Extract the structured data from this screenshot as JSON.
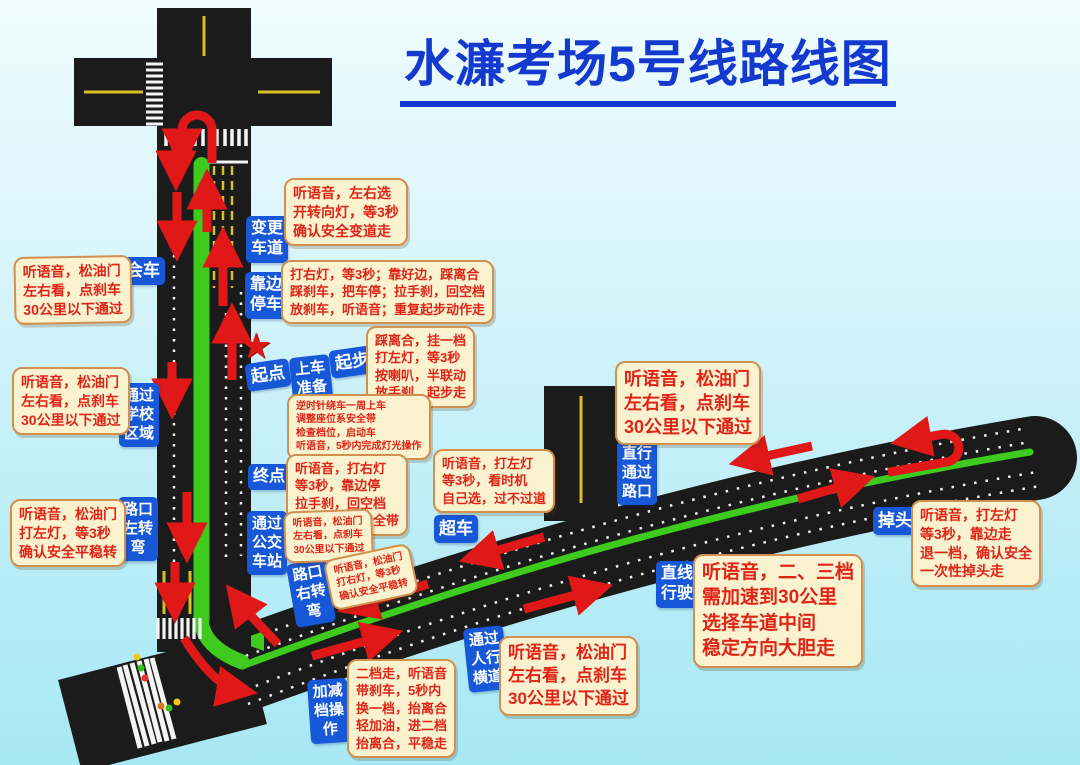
{
  "title": "水濂考场5号线路线图",
  "icons": {
    "star": "★"
  },
  "colors": {
    "title_blue": "#1439cf",
    "label_bg": "#1658d8",
    "note_bg": "#fbf3cf",
    "note_border": "#cf9050",
    "note_text": "#e02518",
    "road": "#1b1b1b",
    "median_green": "#3ecb1e",
    "arrow_red": "#e11818",
    "lane_yellow": "#d8c022"
  },
  "labels": {
    "huiche": "会车",
    "biangeng": "变更\n车道",
    "kaobian": "靠边\n停车",
    "qidian": "起点",
    "shangche": "上车\n准备",
    "qibu": "起步",
    "xuexiao": "通过\n学校\n区域",
    "zhongdian": "终点",
    "gongjiao": "通过\n公交\n车站",
    "zuozhuan": "路口\n左转\n弯",
    "youzhuan": "路口\n右转\n弯",
    "chaoche": "超车",
    "zhixing_lukou": "直行\n通过\n路口",
    "zhixian": "直线\n行驶",
    "diaotou": "掉头",
    "renxing": "通过\n人行\n横道",
    "jiajiandang": "加减\n档操\n作"
  },
  "notes": {
    "huiche": "听语音，松油门\n左右看，点刹车\n30公里以下通过",
    "xuexiao": "听语音，松油门\n左右看，点刹车\n30公里以下通过",
    "zuozhuan": "听语音，松油门\n打左灯，等3秒\n确认安全平稳转",
    "biangeng": "听语音，左右选\n开转向灯，等3秒\n确认安全变道走",
    "kaobian": "打右灯，等3秒；靠好边，踩离合\n踩刹车，把车停；拉手刹，回空档\n放刹车，听语音；重复起步动作走",
    "qibu": "踩离合，挂一档\n打左灯，等3秒\n按喇叭，半联动\n放手刹，起步走",
    "shangche": "逆时针绕车一周上车\n调整座位系安全带\n检查档位，启动车\n听语音，5秒内完成灯光操作",
    "zhongdian": "听语音，打右灯\n等3秒，靠边停\n拉手刹，回空档\n听语音，松安全带",
    "gongjiao": "听语音，松油门\n左右看，点刹车\n30公里以下通过",
    "youzhuan": "听语音，松油门\n打右灯，等3秒\n确认安全平稳转",
    "chaoche": "听语音，打左灯\n等3秒，看时机\n自己选，过不过道",
    "zhixing_lukou": "听语音，松油门\n左右看，点刹车\n30公里以下通过",
    "zhixian": "听语音，二、三档\n需加速到30公里\n选择车道中间\n稳定方向大胆走",
    "diaotou": "听语音，打左灯\n等3秒，靠边走\n退一档，确认安全\n一次性掉头走",
    "renxing": "听语音，松油门\n左右看，点刹车\n30公里以下通过",
    "jiajiandang": "二档走，听语音\n带刹车，5秒内\n换一档，抬离合\n轻加油，进二档\n抬离合，平稳走"
  }
}
